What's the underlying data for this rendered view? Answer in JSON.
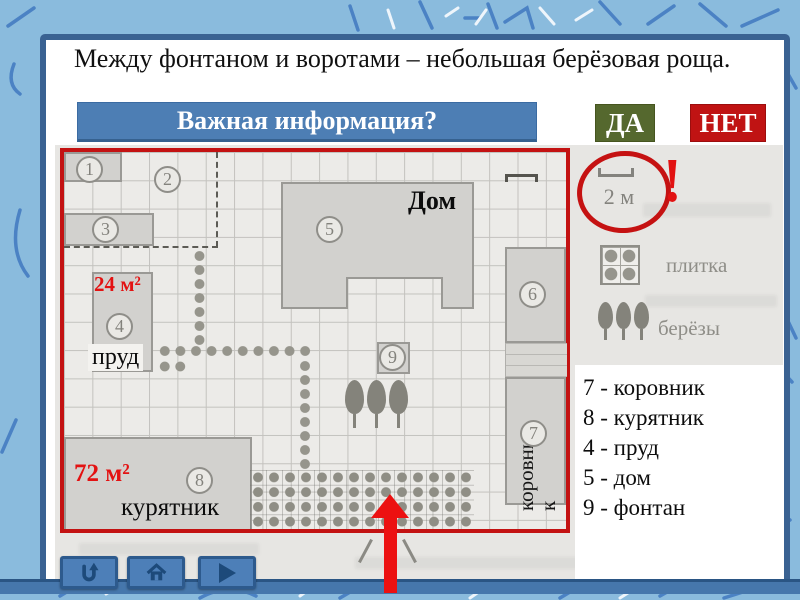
{
  "task": {
    "statement": "Между фонтаном и воротами – небольшая берёзовая роща.",
    "question": "Важная информация?",
    "yes_label": "ДА",
    "no_label": "НЕТ"
  },
  "plan": {
    "markers": [
      "1",
      "2",
      "3",
      "4",
      "5",
      "6",
      "7",
      "8",
      "9"
    ],
    "labels": {
      "house": "Дом",
      "pond": "пруд",
      "pond_area": "24 м²",
      "coop": "курятник",
      "coop_area": "72 м²",
      "cowshed_line1": "коровни",
      "cowshed_line2": "к"
    }
  },
  "legend": {
    "scale": "2 м",
    "alert": "!",
    "tile": "плитка",
    "birches": "берёзы"
  },
  "key": {
    "items": [
      "7 - коровник",
      "8 - курятник",
      "4 - пруд",
      "5 - дом",
      "9 - фонтан"
    ]
  },
  "colors": {
    "accent_red": "#c31212",
    "banner_blue": "#4d7eb4",
    "yes_green": "#55682e",
    "no_red": "#c01313"
  }
}
